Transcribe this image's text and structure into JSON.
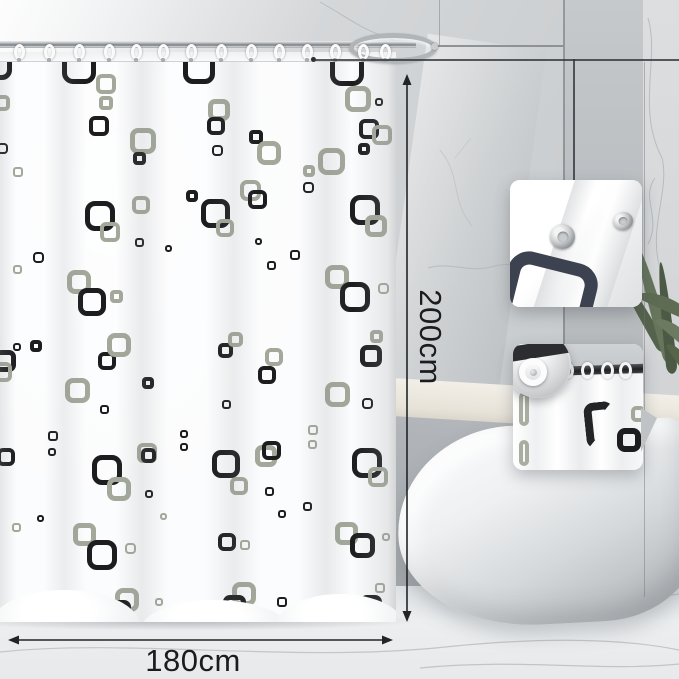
{
  "annotations": {
    "color": "#222427",
    "height": {
      "label": "200cm",
      "x": 407,
      "y_top": 74,
      "y_bottom": 622,
      "label_cx": 430,
      "label_cy": 337
    },
    "width": {
      "label": "180cm",
      "y": 640,
      "x_left": 8,
      "x_right": 393,
      "label_cx": 193,
      "label_cy": 661
    }
  },
  "leader": {
    "dot_x": 311,
    "dot_y": 59,
    "h_x2": 679,
    "corner_x": 573,
    "v_y2": 180
  },
  "curtain": {
    "left": 0,
    "top": 52,
    "width": 396,
    "height": 570,
    "pattern_colors": {
      "k": "#1d1d1f",
      "g": "#a3a89b"
    },
    "rings_x": [
      14,
      44,
      74,
      104,
      131,
      158,
      186,
      216,
      246,
      274,
      302,
      330,
      358,
      380
    ],
    "squares": [
      [
        -18,
        50,
        30,
        "k"
      ],
      [
        62,
        50,
        34,
        "k"
      ],
      [
        183,
        52,
        32,
        "k"
      ],
      [
        330,
        52,
        34,
        "k"
      ],
      [
        96,
        74,
        20,
        "g"
      ],
      [
        345,
        86,
        26,
        "g"
      ],
      [
        -6,
        95,
        16,
        "g"
      ],
      [
        -3,
        143,
        11,
        "k"
      ],
      [
        13,
        167,
        10,
        "g"
      ],
      [
        99,
        96,
        14,
        "g"
      ],
      [
        89,
        116,
        20,
        "k"
      ],
      [
        130,
        128,
        26,
        "g"
      ],
      [
        133,
        152,
        13,
        "k"
      ],
      [
        208,
        99,
        22,
        "g"
      ],
      [
        207,
        117,
        18,
        "k"
      ],
      [
        249,
        130,
        14,
        "k"
      ],
      [
        257,
        141,
        24,
        "g"
      ],
      [
        318,
        148,
        27,
        "g"
      ],
      [
        359,
        119,
        20,
        "k"
      ],
      [
        372,
        125,
        20,
        "g"
      ],
      [
        186,
        190,
        12,
        "k"
      ],
      [
        212,
        145,
        11,
        "k"
      ],
      [
        358,
        143,
        12,
        "k"
      ],
      [
        375,
        98,
        8,
        "k"
      ],
      [
        85,
        201,
        30,
        "k"
      ],
      [
        100,
        222,
        20,
        "g"
      ],
      [
        132,
        196,
        18,
        "g"
      ],
      [
        135,
        238,
        9,
        "k"
      ],
      [
        165,
        245,
        7,
        "k"
      ],
      [
        33,
        252,
        11,
        "k"
      ],
      [
        13,
        265,
        9,
        "g"
      ],
      [
        67,
        270,
        24,
        "g"
      ],
      [
        78,
        288,
        28,
        "k"
      ],
      [
        110,
        290,
        13,
        "g"
      ],
      [
        201,
        199,
        29,
        "k"
      ],
      [
        216,
        219,
        18,
        "g"
      ],
      [
        240,
        180,
        21,
        "g"
      ],
      [
        248,
        190,
        19,
        "k"
      ],
      [
        255,
        238,
        7,
        "k"
      ],
      [
        290,
        250,
        10,
        "k"
      ],
      [
        267,
        261,
        9,
        "k"
      ],
      [
        303,
        165,
        12,
        "g"
      ],
      [
        303,
        182,
        11,
        "k"
      ],
      [
        350,
        195,
        30,
        "k"
      ],
      [
        365,
        215,
        22,
        "g"
      ],
      [
        325,
        265,
        24,
        "g"
      ],
      [
        340,
        282,
        30,
        "k"
      ],
      [
        378,
        283,
        11,
        "g"
      ],
      [
        370,
        330,
        13,
        "g"
      ],
      [
        360,
        345,
        22,
        "k"
      ],
      [
        218,
        343,
        15,
        "k"
      ],
      [
        228,
        332,
        15,
        "g"
      ],
      [
        265,
        348,
        18,
        "g"
      ],
      [
        258,
        366,
        18,
        "k"
      ],
      [
        30,
        340,
        12,
        "k"
      ],
      [
        13,
        343,
        8,
        "k"
      ],
      [
        98,
        352,
        18,
        "k"
      ],
      [
        107,
        333,
        24,
        "g"
      ],
      [
        -6,
        350,
        22,
        "k"
      ],
      [
        -8,
        362,
        20,
        "g"
      ],
      [
        65,
        378,
        25,
        "g"
      ],
      [
        100,
        405,
        9,
        "k"
      ],
      [
        142,
        377,
        12,
        "k"
      ],
      [
        48,
        431,
        10,
        "k"
      ],
      [
        48,
        448,
        8,
        "k"
      ],
      [
        180,
        430,
        8,
        "k"
      ],
      [
        180,
        443,
        8,
        "k"
      ],
      [
        -3,
        448,
        18,
        "k"
      ],
      [
        92,
        455,
        30,
        "k"
      ],
      [
        107,
        477,
        24,
        "g"
      ],
      [
        137,
        443,
        20,
        "g"
      ],
      [
        141,
        448,
        15,
        "k"
      ],
      [
        145,
        490,
        8,
        "k"
      ],
      [
        160,
        513,
        7,
        "g"
      ],
      [
        12,
        523,
        9,
        "g"
      ],
      [
        37,
        515,
        7,
        "k"
      ],
      [
        73,
        523,
        23,
        "g"
      ],
      [
        87,
        540,
        30,
        "k"
      ],
      [
        125,
        543,
        11,
        "g"
      ],
      [
        115,
        588,
        24,
        "g"
      ],
      [
        108,
        600,
        23,
        "k"
      ],
      [
        155,
        598,
        8,
        "g"
      ],
      [
        222,
        400,
        9,
        "k"
      ],
      [
        325,
        382,
        25,
        "g"
      ],
      [
        362,
        398,
        11,
        "k"
      ],
      [
        308,
        425,
        10,
        "g"
      ],
      [
        308,
        440,
        9,
        "g"
      ],
      [
        255,
        445,
        22,
        "g"
      ],
      [
        262,
        441,
        19,
        "k"
      ],
      [
        212,
        450,
        28,
        "k"
      ],
      [
        230,
        477,
        18,
        "g"
      ],
      [
        265,
        487,
        9,
        "k"
      ],
      [
        352,
        448,
        30,
        "k"
      ],
      [
        368,
        467,
        20,
        "g"
      ],
      [
        278,
        510,
        8,
        "k"
      ],
      [
        303,
        502,
        9,
        "k"
      ],
      [
        382,
        533,
        8,
        "g"
      ],
      [
        335,
        522,
        23,
        "g"
      ],
      [
        350,
        533,
        25,
        "k"
      ],
      [
        240,
        540,
        10,
        "g"
      ],
      [
        218,
        533,
        18,
        "k"
      ],
      [
        232,
        582,
        24,
        "g"
      ],
      [
        223,
        595,
        23,
        "k"
      ],
      [
        277,
        597,
        10,
        "k"
      ],
      [
        375,
        583,
        10,
        "g"
      ],
      [
        360,
        595,
        22,
        "k"
      ]
    ]
  },
  "plant": {
    "leaves": [
      [
        634,
        258,
        11,
        100,
        -30,
        "#55634c"
      ],
      [
        648,
        244,
        13,
        122,
        -16,
        "#66755b"
      ],
      [
        661,
        262,
        11,
        112,
        -6,
        "#4c5a45"
      ],
      [
        636,
        298,
        62,
        13,
        24,
        "#5d6c53"
      ],
      [
        652,
        328,
        52,
        12,
        40,
        "#6b7a61"
      ],
      [
        662,
        352,
        34,
        10,
        56,
        "#566449"
      ]
    ]
  },
  "inset_rings_x": [
    8,
    28,
    48,
    68,
    88,
    106
  ]
}
